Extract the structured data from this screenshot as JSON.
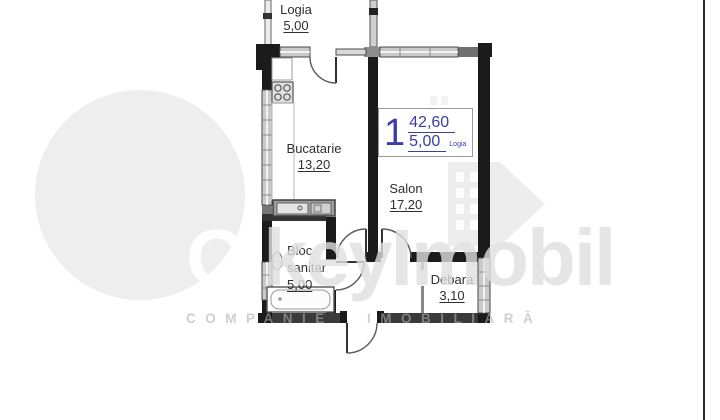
{
  "document_type": "apartment floor plan",
  "rooms": [
    {
      "id": "logia",
      "name": "Logia",
      "area": "5,00"
    },
    {
      "id": "bucatarie",
      "name": "Bucatarie",
      "area": "13,20"
    },
    {
      "id": "salon",
      "name": "Salon",
      "area": "17,20"
    },
    {
      "id": "bloc-sanitar",
      "name": "Bloc sanitar",
      "area": "5,00"
    },
    {
      "id": "debara",
      "name": "Debara",
      "area": "3,10"
    }
  ],
  "total_label": {
    "index": "1",
    "total_area": "42,60",
    "secondary_area": "5,00",
    "secondary_suffix": "Logia"
  },
  "watermark": {
    "prefix": "O'",
    "brand": "keyImobil",
    "subtitle": "COMPANIE IMOBILIARĂ"
  },
  "colors": {
    "wall_black": "#1b1b1b",
    "window_gray": "#c9c9c9",
    "accent_blue": "#3c3ca6",
    "watermark_gray": "#e9e9e9"
  }
}
